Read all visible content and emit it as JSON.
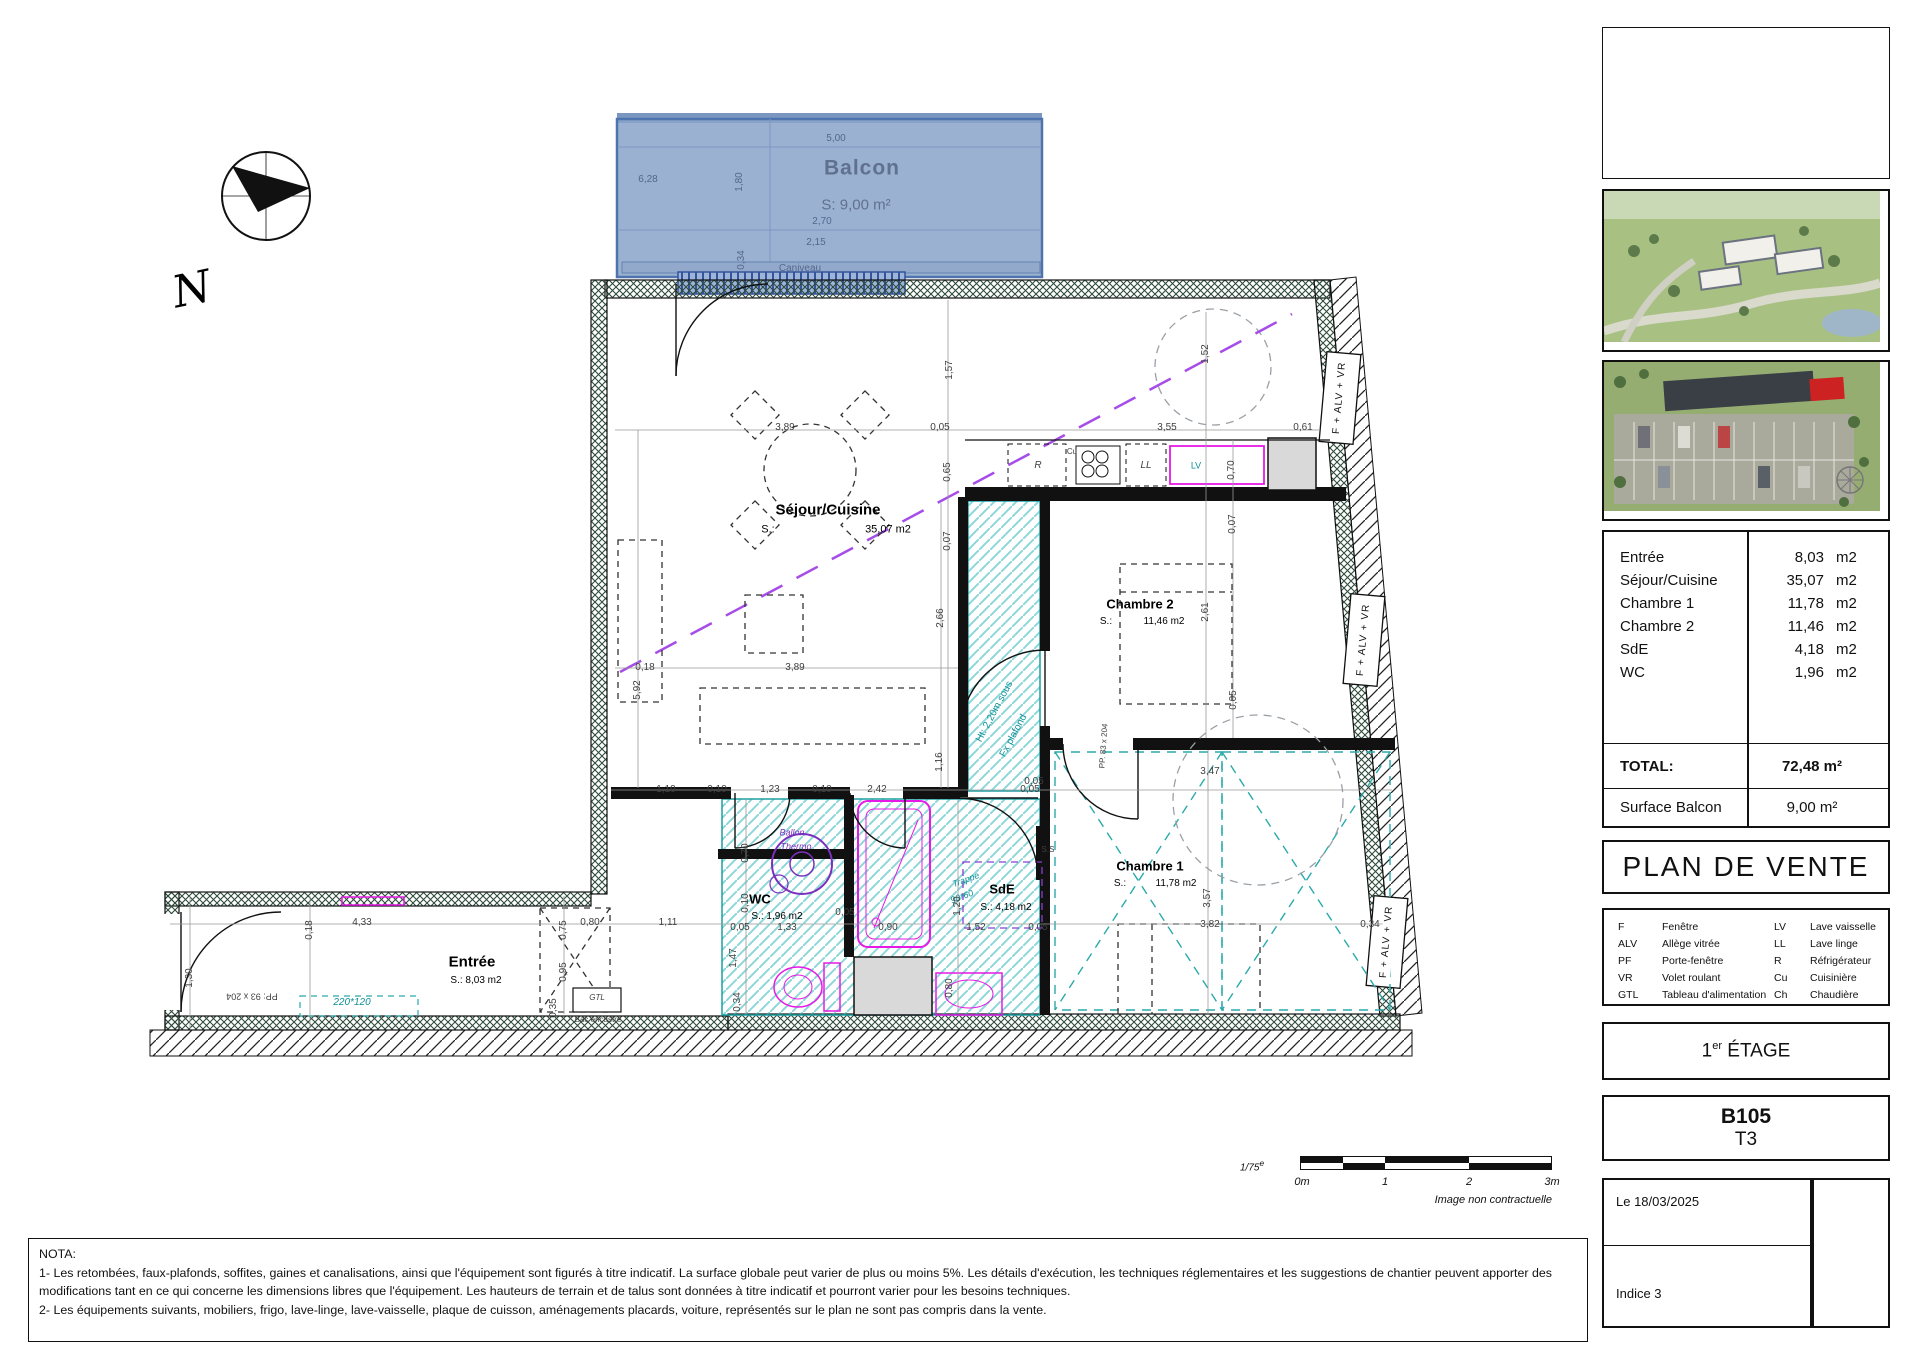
{
  "plan": {
    "labels": [
      {
        "t": "5,00",
        "x": 836,
        "y": 139,
        "c": "bd",
        "n": "dim-balcon-500"
      },
      {
        "t": "Balcon",
        "x": 862,
        "y": 168,
        "c": "bt",
        "n": "balcon-title"
      },
      {
        "t": "S: 9,00 m²",
        "x": 856,
        "y": 205,
        "c": "ba",
        "n": "balcon-area"
      },
      {
        "t": "6,28",
        "x": 648,
        "y": 180,
        "c": "bd",
        "n": "dim-balcon-628"
      },
      {
        "t": "1,80",
        "x": 740,
        "y": 182,
        "r": -90,
        "c": "bd",
        "n": "dim-balcon-180"
      },
      {
        "t": "2,70",
        "x": 822,
        "y": 222,
        "c": "bd",
        "n": "dim-balcon-270"
      },
      {
        "t": "2,15",
        "x": 816,
        "y": 243,
        "c": "bd",
        "n": "dim-balcon-215"
      },
      {
        "t": "0,34",
        "x": 742,
        "y": 260,
        "r": -90,
        "c": "bd",
        "n": "dim-balcon-034"
      },
      {
        "t": "Caniveau",
        "x": 800,
        "y": 269,
        "c": "bd s8",
        "n": "caniveau-label"
      },
      {
        "t": "Séjour/Cuisine",
        "x": 828,
        "y": 510,
        "c": "room",
        "n": "room-sejour-cuisine"
      },
      {
        "t": "S.:",
        "x": 768,
        "y": 530,
        "c": "area",
        "n": "room-sejour-s"
      },
      {
        "t": "35,07 m2",
        "x": 888,
        "y": 530,
        "c": "area",
        "n": "room-sejour-area"
      },
      {
        "t": "3,89",
        "x": 785,
        "y": 428,
        "c": "d",
        "n": "dim"
      },
      {
        "t": "0,05",
        "x": 940,
        "y": 428,
        "c": "d",
        "n": "dim"
      },
      {
        "t": "3,55",
        "x": 1167,
        "y": 428,
        "c": "d",
        "n": "dim"
      },
      {
        "t": "0,61",
        "x": 1303,
        "y": 428,
        "c": "d",
        "n": "dim"
      },
      {
        "t": "1,57",
        "x": 950,
        "y": 370,
        "r": -90,
        "c": "d",
        "n": "dim"
      },
      {
        "t": "0,65",
        "x": 948,
        "y": 472,
        "r": -90,
        "c": "d",
        "n": "dim"
      },
      {
        "t": "0,07",
        "x": 948,
        "y": 541,
        "r": -90,
        "c": "d",
        "n": "dim"
      },
      {
        "t": "1,52",
        "x": 1206,
        "y": 354,
        "r": -90,
        "c": "d",
        "n": "dim"
      },
      {
        "t": "5,92",
        "x": 638,
        "y": 690,
        "r": -90,
        "c": "d",
        "n": "dim"
      },
      {
        "t": "0,18",
        "x": 645,
        "y": 668,
        "c": "d",
        "n": "dim"
      },
      {
        "t": "3,89",
        "x": 795,
        "y": 668,
        "c": "d",
        "n": "dim"
      },
      {
        "t": "2,66",
        "x": 941,
        "y": 618,
        "r": -90,
        "c": "d",
        "n": "dim"
      },
      {
        "t": "1,16",
        "x": 940,
        "y": 762,
        "r": -90,
        "c": "d",
        "n": "dim"
      },
      {
        "t": "1,10",
        "x": 666,
        "y": 790,
        "c": "d",
        "n": "dim"
      },
      {
        "t": "0,10",
        "x": 717,
        "y": 790,
        "c": "d",
        "n": "dim"
      },
      {
        "t": "1,23",
        "x": 770,
        "y": 790,
        "c": "d",
        "n": "dim"
      },
      {
        "t": "0,10",
        "x": 822,
        "y": 790,
        "c": "d",
        "n": "dim"
      },
      {
        "t": "2,42",
        "x": 877,
        "y": 790,
        "c": "d",
        "n": "dim"
      },
      {
        "t": "0,05",
        "x": 1030,
        "y": 790,
        "c": "d",
        "n": "dim"
      },
      {
        "t": "R",
        "x": 1038,
        "y": 466,
        "c": "d i",
        "n": "appliance-fridge-label"
      },
      {
        "t": "Cu",
        "x": 1072,
        "y": 452,
        "c": "d s8",
        "n": "appliance-cooker-label"
      },
      {
        "t": "LL",
        "x": 1146,
        "y": 466,
        "c": "d i",
        "n": "appliance-washer-label"
      },
      {
        "t": "LV",
        "x": 1196,
        "y": 466,
        "c": "teal s9",
        "n": "appliance-dishwasher-label"
      },
      {
        "t": "0,70",
        "x": 1232,
        "y": 470,
        "r": -90,
        "c": "d",
        "n": "dim"
      },
      {
        "t": "Chambre 2",
        "x": 1140,
        "y": 604,
        "c": "room2",
        "n": "room-chambre2"
      },
      {
        "t": "S.:",
        "x": 1106,
        "y": 622,
        "c": "area s10",
        "n": "room-chambre2-s"
      },
      {
        "t": "11,46 m2",
        "x": 1164,
        "y": 622,
        "c": "area s10",
        "n": "room-chambre2-area"
      },
      {
        "t": "2,61",
        "x": 1206,
        "y": 612,
        "r": -90,
        "c": "d",
        "n": "dim"
      },
      {
        "t": "0,07",
        "x": 1233,
        "y": 524,
        "r": -90,
        "c": "d",
        "n": "dim"
      },
      {
        "t": "0,05",
        "x": 1234,
        "y": 700,
        "r": -90,
        "c": "d",
        "n": "dim"
      },
      {
        "t": "PP. 83 x 204",
        "x": 1104,
        "y": 746,
        "r": -86,
        "c": "d s8",
        "n": "door-size-label"
      },
      {
        "t": "Chambre 1",
        "x": 1150,
        "y": 866,
        "c": "room2",
        "n": "room-chambre1"
      },
      {
        "t": "S.:",
        "x": 1120,
        "y": 884,
        "c": "area s10",
        "n": "room-chambre1-s"
      },
      {
        "t": "11,78 m2",
        "x": 1176,
        "y": 884,
        "c": "area s10",
        "n": "room-chambre1-area"
      },
      {
        "t": "3,47",
        "x": 1210,
        "y": 772,
        "c": "d",
        "n": "dim"
      },
      {
        "t": "3,82",
        "x": 1210,
        "y": 925,
        "c": "d",
        "n": "dim"
      },
      {
        "t": "3,57",
        "x": 1208,
        "y": 898,
        "r": -90,
        "c": "d",
        "n": "dim"
      },
      {
        "t": "0,34",
        "x": 1370,
        "y": 925,
        "c": "d",
        "n": "dim"
      },
      {
        "t": "0,05",
        "x": 1034,
        "y": 782,
        "c": "d",
        "n": "dim"
      },
      {
        "t": "Ht: 2,20m sous",
        "x": 995,
        "y": 712,
        "r": -62,
        "c": "teal s10",
        "n": "height-note-line1"
      },
      {
        "t": "Fx plafond",
        "x": 1014,
        "y": 736,
        "r": -62,
        "c": "teal s10",
        "n": "height-note-line2"
      },
      {
        "t": "S.S",
        "x": 1048,
        "y": 850,
        "c": "d s8",
        "n": "towel-rail-label"
      },
      {
        "t": "Ballon",
        "x": 792,
        "y": 833,
        "c": "purp s9 i",
        "n": "water-heater-label1"
      },
      {
        "t": "Thermo",
        "x": 796,
        "y": 847,
        "c": "purp s9 i",
        "n": "water-heater-label2"
      },
      {
        "t": "WC",
        "x": 760,
        "y": 899,
        "c": "room2",
        "n": "room-wc"
      },
      {
        "t": "S.: 1,96 m2",
        "x": 777,
        "y": 917,
        "c": "area s10",
        "n": "room-wc-area"
      },
      {
        "t": "SdE",
        "x": 1002,
        "y": 889,
        "c": "room2",
        "n": "room-sde"
      },
      {
        "t": "S.: 4,18 m2",
        "x": 1006,
        "y": 908,
        "c": "area s10",
        "n": "room-sde-area"
      },
      {
        "t": "Trappe",
        "x": 966,
        "y": 880,
        "r": -20,
        "c": "teal s9 i",
        "n": "trap-label1"
      },
      {
        "t": "90*60",
        "x": 962,
        "y": 897,
        "r": -20,
        "c": "teal s9 i",
        "n": "trap-label2"
      },
      {
        "t": "0,70",
        "x": 746,
        "y": 853,
        "r": -90,
        "c": "d",
        "n": "dim"
      },
      {
        "t": "0,10",
        "x": 746,
        "y": 903,
        "r": -90,
        "c": "d",
        "n": "dim"
      },
      {
        "t": "0,05",
        "x": 740,
        "y": 928,
        "c": "d",
        "n": "dim"
      },
      {
        "t": "1,33",
        "x": 787,
        "y": 928,
        "c": "d",
        "n": "dim"
      },
      {
        "t": "0,05",
        "x": 845,
        "y": 913,
        "c": "d",
        "n": "dim"
      },
      {
        "t": "0,90",
        "x": 888,
        "y": 928,
        "c": "d",
        "n": "dim"
      },
      {
        "t": "1,52",
        "x": 976,
        "y": 928,
        "c": "d",
        "n": "dim"
      },
      {
        "t": "0,05",
        "x": 1038,
        "y": 928,
        "c": "d",
        "n": "dim"
      },
      {
        "t": "1,20",
        "x": 958,
        "y": 906,
        "r": -90,
        "c": "d",
        "n": "dim"
      },
      {
        "t": "0,80",
        "x": 950,
        "y": 988,
        "r": -90,
        "c": "d",
        "n": "dim"
      },
      {
        "t": "1,47",
        "x": 734,
        "y": 958,
        "r": -90,
        "c": "d",
        "n": "dim"
      },
      {
        "t": "0,34",
        "x": 738,
        "y": 1002,
        "r": -90,
        "c": "d",
        "n": "dim"
      },
      {
        "t": "Entrée",
        "x": 472,
        "y": 962,
        "c": "room",
        "n": "room-entree"
      },
      {
        "t": "S.: 8,03 m2",
        "x": 476,
        "y": 981,
        "c": "area s10",
        "n": "room-entree-area"
      },
      {
        "t": "4,33",
        "x": 362,
        "y": 923,
        "c": "d",
        "n": "dim"
      },
      {
        "t": "0,18",
        "x": 310,
        "y": 930,
        "r": -90,
        "c": "d",
        "n": "dim"
      },
      {
        "t": "1,30",
        "x": 190,
        "y": 978,
        "r": -90,
        "c": "d",
        "n": "dim"
      },
      {
        "t": "0,80",
        "x": 590,
        "y": 923,
        "c": "d",
        "n": "dim"
      },
      {
        "t": "1,11",
        "x": 668,
        "y": 923,
        "c": "d",
        "n": "dim"
      },
      {
        "t": "0,75",
        "x": 564,
        "y": 930,
        "r": -90,
        "c": "d",
        "n": "dim"
      },
      {
        "t": "0,95",
        "x": 564,
        "y": 972,
        "r": -90,
        "c": "d",
        "n": "dim"
      },
      {
        "t": "PP: 93 x 204",
        "x": 252,
        "y": 996,
        "r": 180,
        "c": "d s9",
        "n": "entry-door-size-label"
      },
      {
        "t": "220*120",
        "x": 352,
        "y": 1003,
        "c": "teal s10 i",
        "n": "window-size-label"
      },
      {
        "t": "GTL",
        "x": 597,
        "y": 998,
        "c": "d s8 i",
        "n": "gtl-label"
      },
      {
        "t": "Bac encastré",
        "x": 598,
        "y": 1020,
        "c": "d s8",
        "n": "bac-encastre-label"
      },
      {
        "t": "0,35",
        "x": 554,
        "y": 1008,
        "r": -90,
        "c": "d",
        "n": "dim"
      },
      {
        "t": "F + ALV + VR",
        "x": 1340,
        "y": 398,
        "r": -85,
        "c": "win",
        "n": "window-label-1"
      },
      {
        "t": "F + ALV + VR",
        "x": 1364,
        "y": 640,
        "r": -85,
        "c": "win",
        "n": "window-label-2"
      },
      {
        "t": "F + ALV + VR",
        "x": 1387,
        "y": 942,
        "r": -85,
        "c": "win",
        "n": "window-label-3"
      },
      {
        "t": "N",
        "x": 192,
        "y": 290,
        "r": -12,
        "c": "north",
        "n": "north-letter"
      }
    ]
  },
  "scalebar": {
    "ratio": "1/75",
    "ratio_sup": "e",
    "t0": "0m",
    "t1": "1",
    "t2": "2",
    "t3": "3m",
    "note": "Image non contractuelle"
  },
  "sidebar": {
    "areas": {
      "rows": [
        {
          "label": "Entrée",
          "value": "8,03",
          "unit": "m2"
        },
        {
          "label": "Séjour/Cuisine",
          "value": "35,07",
          "unit": "m2"
        },
        {
          "label": "Chambre 1",
          "value": "11,78",
          "unit": "m2"
        },
        {
          "label": "Chambre 2",
          "value": "11,46",
          "unit": "m2"
        },
        {
          "label": "SdE",
          "value": "4,18",
          "unit": "m2"
        },
        {
          "label": "WC",
          "value": "1,96",
          "unit": "m2"
        }
      ],
      "total_label": "TOTAL:",
      "total_value": "72,48 m²",
      "balcony_label": "Surface Balcon",
      "balcony_value": "9,00 m²"
    },
    "title": "PLAN DE VENTE",
    "legend": {
      "col1": [
        [
          "F",
          "Fenêtre"
        ],
        [
          "ALV",
          "Allège vitrée"
        ],
        [
          "PF",
          "Porte-fenêtre"
        ],
        [
          "VR",
          "Volet roulant"
        ],
        [
          "GTL",
          "Tableau d'alimentation"
        ]
      ],
      "col2": [
        [
          "LV",
          "Lave vaisselle"
        ],
        [
          "LL",
          "Lave linge"
        ],
        [
          "R",
          "Réfrigérateur"
        ],
        [
          "Cu",
          "Cuisinière"
        ],
        [
          "Ch",
          "Chaudière"
        ]
      ]
    },
    "floor": {
      "num": "1",
      "sup": "er",
      "rest": " ÉTAGE"
    },
    "unit": {
      "code": "B105",
      "type": "T3"
    },
    "date": "Le 18/03/2025",
    "indice": "Indice 3"
  },
  "nota": {
    "title": "NOTA:",
    "line1": "1-   Les retombées, faux-plafonds, soffites, gaines et canalisations, ainsi que l'équipement sont figurés à titre indicatif. La surface globale peut varier de plus ou moins 5%. Les détails d'exécution, les techniques réglementaires et les suggestions de chantier peuvent apporter des",
    "line2": "modifications tant en ce qui concerne les dimensions libres que l'équipement. Les hauteurs de terrain et de talus sont données à titre indicatif et pourront varier pour les besoins techniques.",
    "line3": "2-  Les équipements suivants, mobiliers, frigo, lave-linge, lave-vaisselle, plaque de cuisson, aménagements placards, voiture, représentés sur le plan ne sont pas compris dans la vente."
  }
}
